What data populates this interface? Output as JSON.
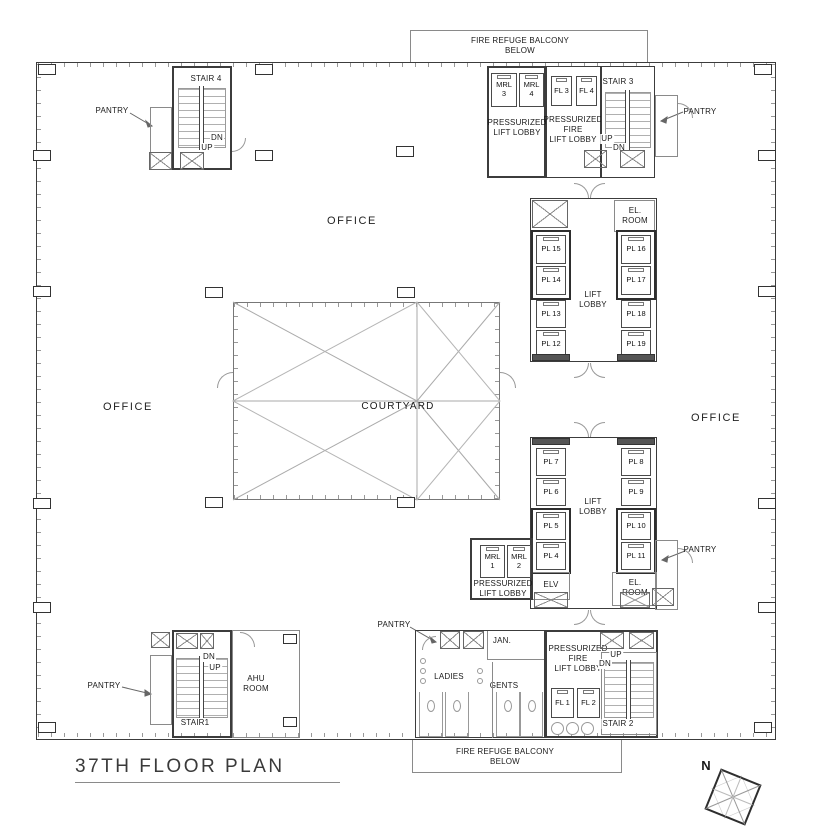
{
  "title": "37TH FLOOR PLAN",
  "north": "N",
  "balcony_top": "FIRE REFUGE BALCONY\nBELOW",
  "balcony_bottom": "FIRE REFUGE BALCONY\nBELOW",
  "office_top": "OFFICE",
  "office_left": "OFFICE",
  "office_right": "OFFICE",
  "courtyard": "COURTYARD",
  "stairs": {
    "stair1": "STAIR1",
    "stair2": "STAIR 2",
    "stair3": "STAIR 3",
    "stair4": "STAIR 4",
    "up": "UP",
    "dn": "DN"
  },
  "pantry_labels": {
    "top_left": "PANTRY",
    "top_right": "PANTRY",
    "mid_right": "PANTRY",
    "bottom_mid": "PANTRY",
    "bottom_left": "PANTRY"
  },
  "lobbies": {
    "upper": "LIFT\nLOBBY",
    "lower": "LIFT\nLOBBY",
    "press_top": "PRESSURIZED\nLIFT LOBBY",
    "press_fire_top": "PRESSURIZED\nFIRE\nLIFT LOBBY",
    "press_mrl": "PRESSURIZED\nLIFT LOBBY",
    "press_fire_bottom": "PRESSURIZED\nFIRE\nLIFT LOBBY"
  },
  "rooms": {
    "el_room_upper": "EL.\nROOM",
    "el_room_lower": "EL.\nROOM",
    "elv": "ELV",
    "ahu": "AHU\nROOM",
    "jan": "JAN.",
    "ladies": "LADIES",
    "gents": "GENTS"
  },
  "lifts": {
    "pl4": "PL 4",
    "pl5": "PL 5",
    "pl6": "PL 6",
    "pl7": "PL 7",
    "pl8": "PL 8",
    "pl9": "PL 9",
    "pl10": "PL 10",
    "pl11": "PL 11",
    "pl12": "PL 12",
    "pl13": "PL 13",
    "pl14": "PL 14",
    "pl15": "PL 15",
    "pl16": "PL 16",
    "pl17": "PL 17",
    "pl18": "PL 18",
    "pl19": "PL 19",
    "fl1": "FL 1",
    "fl2": "FL 2",
    "fl3": "FL 3",
    "fl4": "FL 4",
    "mrl1": "MRL\n1",
    "mrl2": "MRL\n2",
    "mrl3": "MRL\n3",
    "mrl4": "MRL\n4"
  },
  "colors": {
    "wall": "#3c3c3c",
    "thin_line": "#8a8a8a",
    "text": "#1a1a1a"
  }
}
